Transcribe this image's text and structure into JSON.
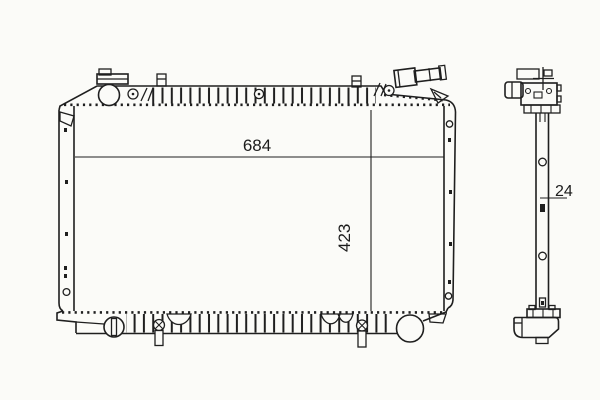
{
  "colors": {
    "background": "#fbfbf8",
    "line": "#1f1f1f",
    "text": "#1c1c1c"
  },
  "dimensions": {
    "front_width": "684",
    "front_height": "423",
    "side_depth": "24"
  }
}
